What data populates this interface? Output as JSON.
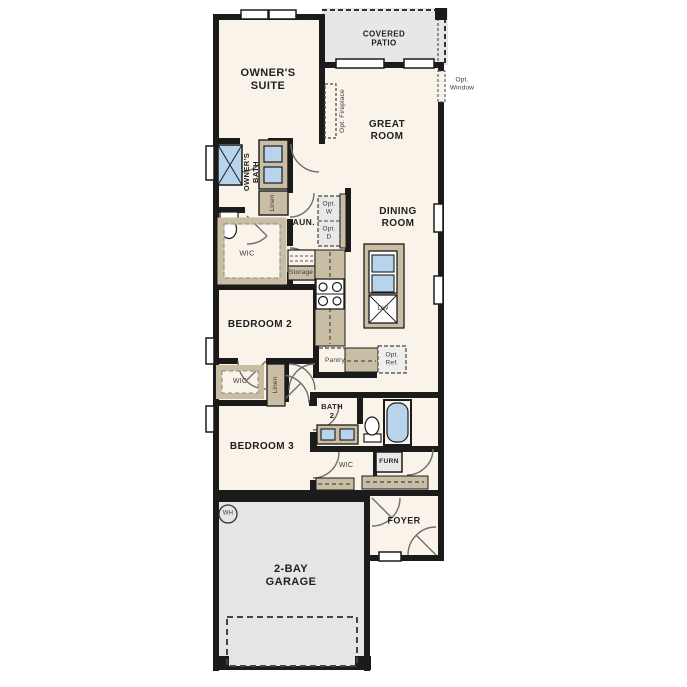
{
  "plan": {
    "title": "single-story floor plan",
    "rooms": {
      "owners_suite": "OWNER'S\nSUITE",
      "covered_patio": "COVERED\nPATIO",
      "great_room": "GREAT\nROOM",
      "dining_room": "DINING\nROOM",
      "owners_bath": "OWNER'S\nBATH",
      "laundry": "LAUN.",
      "bedroom2": "BEDROOM 2",
      "bedroom3": "BEDROOM 3",
      "bath2": "BATH\n2",
      "foyer": "FOYER",
      "garage": "2-BAY\nGARAGE"
    },
    "closets": {
      "wic_owner": "WIC",
      "wic_bed2": "WIC",
      "wic_bed3": "WIC",
      "linen_bath": "Linen",
      "linen_hall": "Linen",
      "storage": "Storage",
      "pantry": "Pantry"
    },
    "options": {
      "fireplace": "Opt. Fireplace",
      "window": "Opt.\nWindow",
      "washer": "Opt.\nW",
      "dryer": "Opt.\nD",
      "refrigerator": "Opt.\nRef."
    },
    "equipment": {
      "furnace": "FURN",
      "water_heater": "WH",
      "dishwasher": "DW"
    },
    "colors": {
      "wall": "#1b1b1b",
      "floor": "#faf3e9",
      "garage_floor": "#e5e5e3",
      "patio_floor": "#e7e7e5",
      "cabinet_tan": "#c9bda3",
      "fixture_blue": "#b8d4ec",
      "door_swing": "#6e6e6e"
    }
  }
}
